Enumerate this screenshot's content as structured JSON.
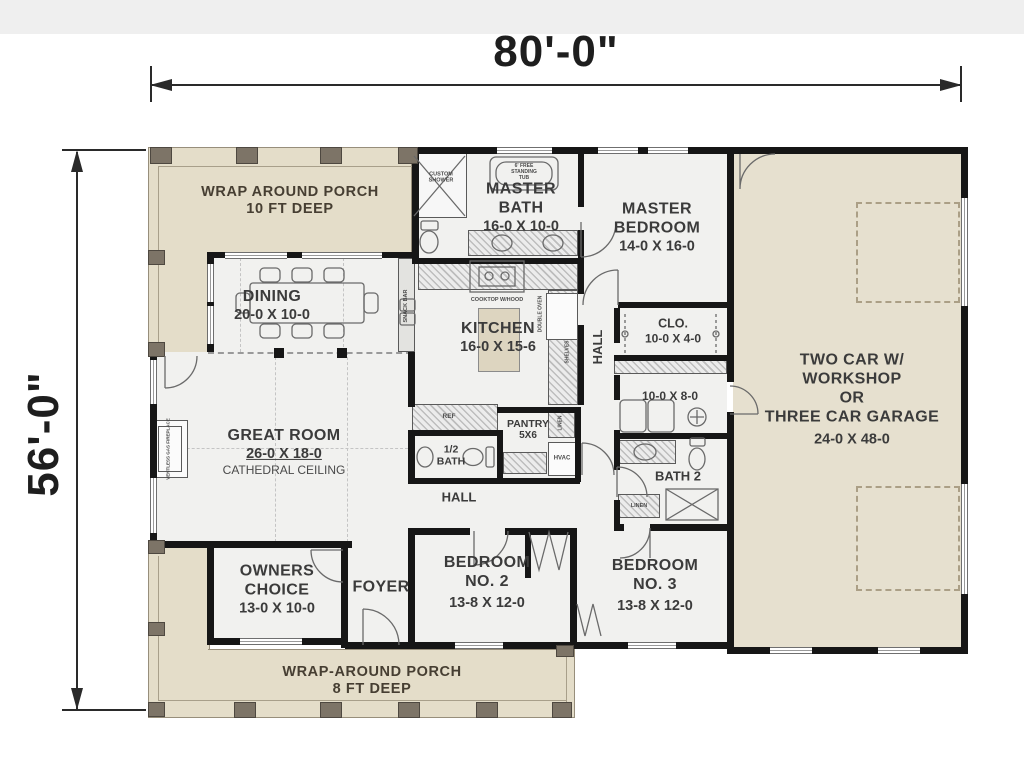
{
  "dimensions": {
    "width": "80'-0\"",
    "height": "56'-0\""
  },
  "rooms": {
    "porch_top": {
      "l1": "WRAP AROUND PORCH",
      "l2": "10 FT DEEP"
    },
    "porch_bottom": {
      "l1": "WRAP-AROUND PORCH",
      "l2": "8 FT DEEP"
    },
    "master_bath": {
      "l1": "MASTER",
      "l2": "BATH",
      "size": "16-0 X 10-0"
    },
    "master_bedroom": {
      "l1": "MASTER",
      "l2": "BEDROOM",
      "size": "14-0 X 16-0"
    },
    "dining": {
      "name": "DINING",
      "size": "20-0 X 10-0"
    },
    "kitchen": {
      "name": "KITCHEN",
      "size": "16-0 X 15-6"
    },
    "great_room": {
      "name": "GREAT ROOM",
      "size": "26-0 X 18-0",
      "note": "CATHEDRAL CEILING"
    },
    "closet": {
      "name": "CLO.",
      "size": "10-0 X 4-0"
    },
    "laundry": {
      "name": "LAUNDRY/MUD",
      "size": "10-0 X 8-0"
    },
    "garage": {
      "l1": "TWO CAR W/",
      "l2": "WORKSHOP",
      "l3": "OR",
      "l4": "THREE CAR GARAGE",
      "size": "24-0 X 48-0"
    },
    "half_bath": {
      "l1": "1/2",
      "l2": "BATH"
    },
    "pantry": {
      "l1": "PANTRY",
      "l2": "5X6"
    },
    "bath2": {
      "name": "BATH 2"
    },
    "owners": {
      "l1": "OWNERS",
      "l2": "CHOICE",
      "size": "13-0 X 10-0"
    },
    "foyer": {
      "name": "FOYER"
    },
    "bed2": {
      "l1": "BEDROOM",
      "l2": "NO. 2",
      "size": "13-8 X 12-0"
    },
    "bed3": {
      "l1": "BEDROOM",
      "l2": "NO. 3",
      "size": "13-8 X 12-0"
    },
    "hall_upper": "HALL",
    "hall_lower": "HALL"
  },
  "fixtures": {
    "shower_l1": "CUSTOM",
    "shower_l2": "SHOWER",
    "tub_l1": "6' FREE",
    "tub_l2": "STANDING",
    "tub_l3": "TUB",
    "cooktop": "COOKTOP W/HOOD",
    "oven": "DOUBLE OVEN",
    "snack_bar": "SNACK BAR",
    "shelves": "SHELVES",
    "ref": "REF",
    "hvac": "HVAC",
    "linen_bath2": "LINEN",
    "linen_hall": "LINEN",
    "fireplace": "VENTLESS GAS FIREPLACE"
  },
  "colors": {
    "porch": "#e4ddc9",
    "garage": "#e6e0cf",
    "wall": "#161616",
    "floor": "#f1f1ef"
  }
}
